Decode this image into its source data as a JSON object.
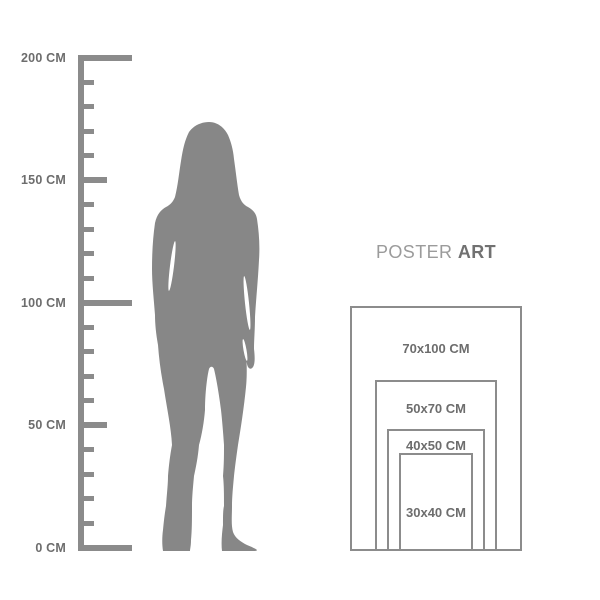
{
  "title": {
    "word_regular": "POSTER",
    "word_bold": "ART"
  },
  "ruler": {
    "unit": "CM",
    "min_cm": 0,
    "max_cm": 200,
    "tick_step_cm": 10,
    "labeled_ticks": [
      {
        "cm": 200,
        "label": "200 CM"
      },
      {
        "cm": 150,
        "label": "150 CM"
      },
      {
        "cm": 100,
        "label": "100 CM"
      },
      {
        "cm": 50,
        "label": "50 CM"
      },
      {
        "cm": 0,
        "label": "0 CM"
      }
    ]
  },
  "figure": {
    "icon": "standing-woman-silhouette"
  },
  "poster_sizes": [
    {
      "label": "70x100 CM",
      "width_cm": 70,
      "height_cm": 100
    },
    {
      "label": "50x70 CM",
      "width_cm": 50,
      "height_cm": 70
    },
    {
      "label": "40x50 CM",
      "width_cm": 40,
      "height_cm": 50
    },
    {
      "label": "30x40 CM",
      "width_cm": 30,
      "height_cm": 40
    }
  ],
  "colors": {
    "background": "#ffffff",
    "ruler": "#8b8b8b",
    "figure": "#878787",
    "rect_border": "#8c8c8c",
    "label_text": "#6d6d6d",
    "title_regular": "#9b9b9b",
    "title_bold": "#717171"
  }
}
